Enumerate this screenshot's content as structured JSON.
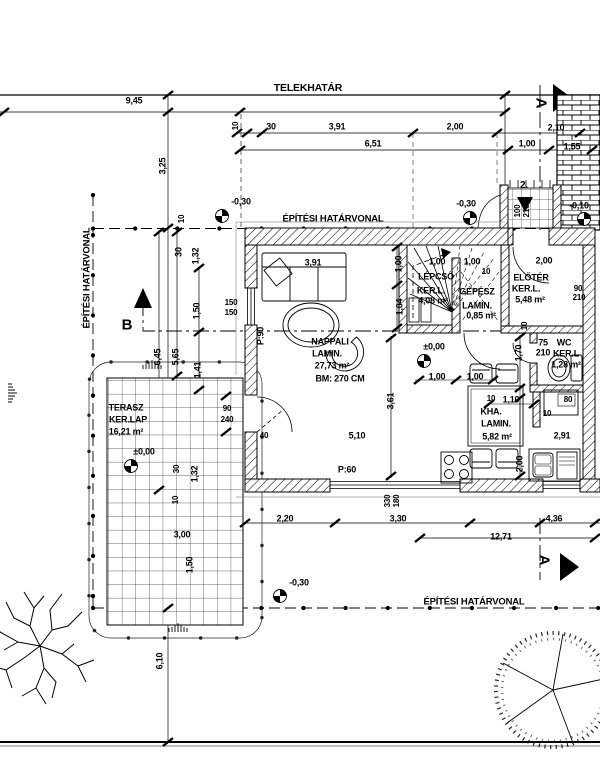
{
  "drawing": {
    "type": "architectural floor plan (helyszínrajz / alaprajz)",
    "language": "Hungarian",
    "ink": "#000000",
    "paper": "#ffffff"
  },
  "boundaries": {
    "property_line_label": "TELEKHATÁR",
    "building_line_label": "ÉPÍTÉSI HATÁRVONAL"
  },
  "sections": {
    "a": "A",
    "b": "B"
  },
  "rooms": [
    {
      "name": "NAPPALI",
      "finish": "LAMIN.",
      "area": "27,73 m²",
      "height": "BM: 270 CM"
    },
    {
      "name": "LÉPCSŐ",
      "finish": "KER.L.",
      "area": "4,08 m²"
    },
    {
      "name": "GÉPÉSZ",
      "finish": "LAMIN.",
      "area": "0,85 m²"
    },
    {
      "name": "ELŐTÉR",
      "finish": "KER.L.",
      "area": "5,48 m²"
    },
    {
      "name": "WC",
      "finish": "KER.L",
      "area": "1,28 m²"
    },
    {
      "name": "KHA.",
      "finish": "LAMIN.",
      "area": "5,82 m²"
    },
    {
      "name": "TERASZ",
      "finish": "KER.LAP",
      "area": "16,21 m²"
    }
  ],
  "levels": [
    "-0,30",
    "-0,30",
    "-0,10",
    "±0,00",
    "±0,00",
    "-0,30"
  ],
  "openings": [
    "150/150",
    "90/240",
    "100/210",
    "90/210",
    "75/210",
    "330/180"
  ],
  "labels": [
    {
      "n": "property-line-label",
      "t": "TELEKHATÁR",
      "x": 308,
      "y": 88,
      "s": 10.5
    },
    {
      "n": "dim-9-45",
      "t": "9,45",
      "x": 134,
      "y": 101
    },
    {
      "n": "dim-3-25",
      "t": "3,25",
      "x": 163,
      "y": 166,
      "r": -90
    },
    {
      "n": "dim-10-top",
      "t": "10",
      "x": 236,
      "y": 126,
      "r": -90,
      "s": 8
    },
    {
      "n": "dim-30-top",
      "t": "30",
      "x": 271,
      "y": 127
    },
    {
      "n": "dim-3-91-top",
      "t": "3,91",
      "x": 337,
      "y": 127
    },
    {
      "n": "dim-2-00-top",
      "t": "2,00",
      "x": 455,
      "y": 127
    },
    {
      "n": "dim-2-10-top",
      "t": "2,10",
      "x": 556,
      "y": 128
    },
    {
      "n": "dim-6-51",
      "t": "6,51",
      "x": 373,
      "y": 144
    },
    {
      "n": "dim-1-00-top",
      "t": "1,00",
      "x": 527,
      "y": 144
    },
    {
      "n": "dim-1-55-top",
      "t": "1,55",
      "x": 572,
      "y": 147
    },
    {
      "n": "level-top-left",
      "t": "-0,30",
      "x": 241,
      "y": 202
    },
    {
      "n": "building-line-label-top",
      "t": "ÉPÍTÉSI HATÁRVONAL",
      "x": 333,
      "y": 219,
      "s": 9.5
    },
    {
      "n": "level-top-right",
      "t": "-0,30",
      "x": 466,
      "y": 204
    },
    {
      "n": "level-right",
      "t": "-0,10",
      "x": 579,
      "y": 206
    },
    {
      "n": "section-a-top-letter",
      "t": "A",
      "x": 541,
      "y": 103,
      "r": 90,
      "s": 15
    },
    {
      "n": "entrance-number",
      "t": "2.",
      "x": 524,
      "y": 186,
      "s": 10
    },
    {
      "n": "door-100-210-w",
      "t": "100",
      "x": 518,
      "y": 211,
      "r": -90,
      "s": 8
    },
    {
      "n": "door-100-210-h",
      "t": "210",
      "x": 527,
      "y": 211,
      "r": -90,
      "s": 8
    },
    {
      "n": "building-line-label-left",
      "t": "ÉPÍTÉSI HATÁRVONAL",
      "x": 87,
      "y": 278,
      "r": -90,
      "s": 9.5
    },
    {
      "n": "section-b-letter",
      "t": "B",
      "x": 127,
      "y": 325,
      "s": 15
    },
    {
      "n": "dim-10-left",
      "t": "10",
      "x": 182,
      "y": 219,
      "r": -90,
      "s": 8
    },
    {
      "n": "dim-30-left",
      "t": "30",
      "x": 179,
      "y": 252,
      "r": -90
    },
    {
      "n": "dim-1-32-left",
      "t": "1,32",
      "x": 196,
      "y": 256,
      "r": -90
    },
    {
      "n": "dim-1-50-left",
      "t": "1,50",
      "x": 197,
      "y": 311,
      "r": -90
    },
    {
      "n": "window-150-150-w",
      "t": "150",
      "x": 231,
      "y": 303,
      "s": 8
    },
    {
      "n": "window-150-150-h",
      "t": "150",
      "x": 231,
      "y": 313,
      "s": 8
    },
    {
      "n": "dim-6-45",
      "t": "6,45",
      "x": 158,
      "y": 357,
      "r": -90
    },
    {
      "n": "dim-5-65",
      "t": "5,65",
      "x": 176,
      "y": 357,
      "r": -90
    },
    {
      "n": "dim-1-41",
      "t": "1,41",
      "x": 198,
      "y": 370,
      "r": -90
    },
    {
      "n": "room-terasz-name",
      "t": "TERASZ",
      "x": 126,
      "y": 408
    },
    {
      "n": "room-terasz-finish",
      "t": "KER.LAP",
      "x": 128,
      "y": 420
    },
    {
      "n": "room-terasz-area",
      "t": "16,21 m²",
      "x": 126,
      "y": 432
    },
    {
      "n": "level-terasz",
      "t": "±0,00",
      "x": 144,
      "y": 452
    },
    {
      "n": "door-90-240-w",
      "t": "90",
      "x": 227,
      "y": 409,
      "s": 8
    },
    {
      "n": "door-90-240-h",
      "t": "240",
      "x": 227,
      "y": 420,
      "s": 8
    },
    {
      "n": "dim-30-terasz",
      "t": "30",
      "x": 177,
      "y": 469,
      "r": -90,
      "s": 8
    },
    {
      "n": "dim-1-32-terasz",
      "t": "1,32",
      "x": 195,
      "y": 474,
      "r": -90
    },
    {
      "n": "dim-10-terasz",
      "t": "10",
      "x": 176,
      "y": 500,
      "r": -90,
      "s": 8
    },
    {
      "n": "dim-3-00",
      "t": "3,00",
      "x": 182,
      "y": 535
    },
    {
      "n": "dim-1-50-bottom",
      "t": "1,50",
      "x": 190,
      "y": 565,
      "r": -90
    },
    {
      "n": "dim-6-10",
      "t": "6,10",
      "x": 160,
      "y": 661,
      "r": -90
    },
    {
      "n": "level-bottom",
      "t": "-0,30",
      "x": 299,
      "y": 583
    },
    {
      "n": "building-line-label-bottom",
      "t": "ÉPÍTÉSI HATÁRVONAL",
      "x": 474,
      "y": 602,
      "s": 9.5
    },
    {
      "n": "section-a-bottom-letter",
      "t": "A",
      "x": 544,
      "y": 560,
      "r": 90,
      "s": 15
    },
    {
      "n": "dim-2-20",
      "t": "2,20",
      "x": 285,
      "y": 519
    },
    {
      "n": "dim-3-30",
      "t": "3,30",
      "x": 398,
      "y": 519
    },
    {
      "n": "window-330-180-w",
      "t": "330",
      "x": 388,
      "y": 501,
      "r": -90,
      "s": 8
    },
    {
      "n": "window-330-180-h",
      "t": "180",
      "x": 397,
      "y": 501,
      "r": -90,
      "s": 8
    },
    {
      "n": "dim-12-71",
      "t": "12,71",
      "x": 501,
      "y": 537
    },
    {
      "n": "dim-4-36",
      "t": "4,36",
      "x": 554,
      "y": 519
    },
    {
      "n": "dim-3-91-sofa",
      "t": "3,91",
      "x": 313,
      "y": 263
    },
    {
      "n": "room-nappali-name",
      "t": "NAPPALI",
      "x": 330,
      "y": 342
    },
    {
      "n": "room-nappali-finish",
      "t": "LAMIN.",
      "x": 327,
      "y": 354
    },
    {
      "n": "room-nappali-area",
      "t": "27,73 m²",
      "x": 332,
      "y": 366
    },
    {
      "n": "room-nappali-height",
      "t": "BM: 270 CM",
      "x": 340,
      "y": 379
    },
    {
      "n": "parapet-p90",
      "t": "P:90",
      "x": 261,
      "y": 336,
      "r": -90
    },
    {
      "n": "dim-1-00-wall",
      "t": "1,00",
      "x": 399,
      "y": 264,
      "r": -90
    },
    {
      "n": "dim-1-04-wall",
      "t": "1,04",
      "x": 400,
      "y": 307,
      "r": -90
    },
    {
      "n": "dim-40",
      "t": "40",
      "x": 264,
      "y": 436,
      "s": 8
    },
    {
      "n": "dim-5-10",
      "t": "5,10",
      "x": 357,
      "y": 436
    },
    {
      "n": "parapet-p60",
      "t": "P:60",
      "x": 347,
      "y": 470
    },
    {
      "n": "dim-3-61",
      "t": "3,61",
      "x": 391,
      "y": 401,
      "r": -90
    },
    {
      "n": "dim-1-00-stair-1",
      "t": "1,00",
      "x": 437,
      "y": 262
    },
    {
      "n": "dim-1-00-stair-2",
      "t": "1,00",
      "x": 472,
      "y": 262
    },
    {
      "n": "dim-10-stair",
      "t": "10",
      "x": 486,
      "y": 272,
      "s": 8
    },
    {
      "n": "room-lepcso-name",
      "t": "LÉPCSŐ",
      "x": 436,
      "y": 277
    },
    {
      "n": "room-lepcso-finish",
      "t": "KER.L.",
      "x": 431,
      "y": 291
    },
    {
      "n": "room-lepcso-area",
      "t": "4,08 m²",
      "x": 433,
      "y": 301
    },
    {
      "n": "room-gepesz-name",
      "t": "GÉPÉSZ",
      "x": 477,
      "y": 292
    },
    {
      "n": "room-gepesz-finish",
      "t": "LAMIN.",
      "x": 477,
      "y": 306
    },
    {
      "n": "room-gepesz-area",
      "t": "0,85 m²",
      "x": 481,
      "y": 316
    },
    {
      "n": "level-hall",
      "t": "±0,00",
      "x": 434,
      "y": 347
    },
    {
      "n": "dim-2-00-eloter",
      "t": "2,00",
      "x": 544,
      "y": 261
    },
    {
      "n": "room-eloter-name",
      "t": "ELŐTÉR",
      "x": 531,
      "y": 278
    },
    {
      "n": "room-eloter-finish",
      "t": "KER.L.",
      "x": 526,
      "y": 289
    },
    {
      "n": "room-eloter-area",
      "t": "5,48 m²",
      "x": 530,
      "y": 300
    },
    {
      "n": "door-90-210-w",
      "t": "90",
      "x": 578,
      "y": 289,
      "s": 8
    },
    {
      "n": "door-90-210-h",
      "t": "210",
      "x": 579,
      "y": 298,
      "s": 8
    },
    {
      "n": "dim-10-hall",
      "t": "10",
      "x": 525,
      "y": 326,
      "r": -90,
      "s": 8
    },
    {
      "n": "door-75-210-w",
      "t": "75",
      "x": 543,
      "y": 343
    },
    {
      "n": "door-75-210-h",
      "t": "210",
      "x": 543,
      "y": 353
    },
    {
      "n": "dim-1-70",
      "t": "1,70",
      "x": 519,
      "y": 353,
      "r": -90
    },
    {
      "n": "room-wc-name",
      "t": "WC",
      "x": 564,
      "y": 343
    },
    {
      "n": "room-wc-finish",
      "t": "KER.L",
      "x": 566,
      "y": 354
    },
    {
      "n": "room-wc-area",
      "t": "1,28 m²",
      "x": 566,
      "y": 365
    },
    {
      "n": "dim-1-00-kha-1",
      "t": "1,00",
      "x": 437,
      "y": 377
    },
    {
      "n": "dim-1-00-kha-2",
      "t": "1,00",
      "x": 475,
      "y": 377
    },
    {
      "n": "dim-10-kha",
      "t": "10",
      "x": 491,
      "y": 399,
      "s": 8
    },
    {
      "n": "dim-1-10-kha",
      "t": "1,10",
      "x": 511,
      "y": 400
    },
    {
      "n": "room-kha-name",
      "t": "KHA.",
      "x": 491,
      "y": 412
    },
    {
      "n": "room-kha-finish",
      "t": "LAMIN.",
      "x": 496,
      "y": 424
    },
    {
      "n": "room-kha-area",
      "t": "5,82 m²",
      "x": 497,
      "y": 437
    },
    {
      "n": "dim-2-91",
      "t": "2,91",
      "x": 562,
      "y": 436
    },
    {
      "n": "fridge-width-80",
      "t": "80",
      "x": 568,
      "y": 400,
      "s": 8
    },
    {
      "n": "dim-10-kha-2",
      "t": "10",
      "x": 547,
      "y": 414,
      "s": 8
    },
    {
      "n": "dim-2-00-kha",
      "t": "2,00",
      "x": 520,
      "y": 464,
      "r": -90
    }
  ]
}
